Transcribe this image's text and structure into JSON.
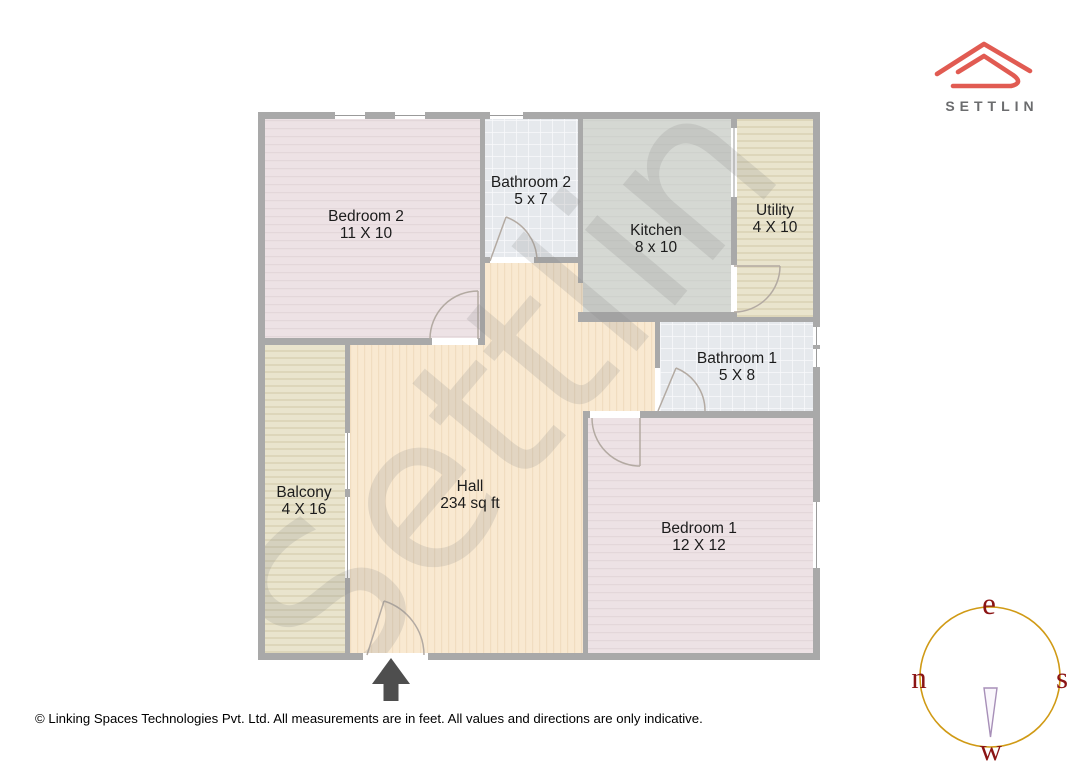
{
  "brand": {
    "name": "SETTLIN"
  },
  "watermark": "Settlin",
  "floor_plan": {
    "rooms": [
      {
        "name": "Bedroom 2",
        "dims": "11 X 10"
      },
      {
        "name": "Bathroom 2",
        "dims": "5 x 7"
      },
      {
        "name": "Kitchen",
        "dims": "8 x 10"
      },
      {
        "name": "Utility",
        "dims": "4 X 10"
      },
      {
        "name": "Bathroom 1",
        "dims": "5 X 8"
      },
      {
        "name": "Balcony",
        "dims": "4 X 16"
      },
      {
        "name": "Hall",
        "dims": "234 sq ft"
      },
      {
        "name": "Bedroom 1",
        "dims": "12 X 12"
      }
    ]
  },
  "compass": {
    "top": "e",
    "left": "n",
    "right": "s",
    "bottom": "w"
  },
  "footer": "© Linking Spaces Technologies Pvt. Ltd. All measurements are in feet. All values and directions are only indicative.",
  "colors": {
    "wall": "#a9a9a9",
    "hall_fill": "#f9e9d1",
    "bedroom_fill": "#ede2e5",
    "bathroom_fill": "#e6e9ed",
    "kitchen_fill": "#d5d8d3",
    "utility_balcony_fill": "#e9e4cd",
    "logo_red": "#e15b52",
    "brand_gray": "#6b6c6e",
    "compass_circle": "#d09a15",
    "compass_letters": "#8b1414",
    "watermark_gray": "#888888",
    "entrance_arrow": "#4e4e4e"
  }
}
